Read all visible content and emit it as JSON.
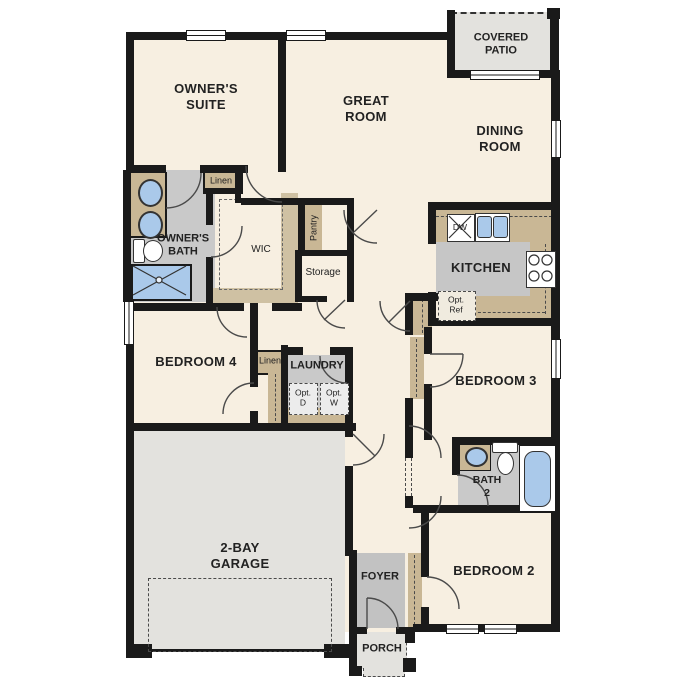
{
  "title": "Single-story floor plan",
  "colors": {
    "wall": "#1a1a1a",
    "floor_cream": "#f7efe1",
    "cabinet_tan": "#c9b795",
    "wet_room_gray": "#c9c9c9",
    "garage_gray": "#e3e2de",
    "fixture_blue": "#aac9ea",
    "background": "#ffffff"
  },
  "labels": {
    "owners_suite": "OWNER'S\nSUITE",
    "great_room": "GREAT\nROOM",
    "dining_room": "DINING\nROOM",
    "covered_patio": "COVERED\nPATIO",
    "owners_bath": "OWNER'S\nBATH",
    "linen1": "Linen",
    "wic": "WIC",
    "pantry": "Pantry",
    "storage": "Storage",
    "kitchen": "KITCHEN",
    "dw": "DW",
    "opt_ref": "Opt.\nRef",
    "bedroom4": "BEDROOM 4",
    "linen2": "Linen",
    "laundry": "LAUNDRY",
    "opt_d": "Opt.\nD",
    "opt_w": "Opt.\nW",
    "bedroom3": "BEDROOM 3",
    "bath2": "BATH\n2",
    "bedroom2": "BEDROOM 2",
    "garage": "2-BAY\nGARAGE",
    "foyer": "FOYER",
    "porch": "PORCH"
  },
  "fixtures": [
    "double-vanity-sinks",
    "toilet",
    "shower",
    "bathtub",
    "kitchen-sink",
    "dishwasher",
    "stove",
    "optional-refrigerator",
    "optional-dryer",
    "optional-washer"
  ]
}
